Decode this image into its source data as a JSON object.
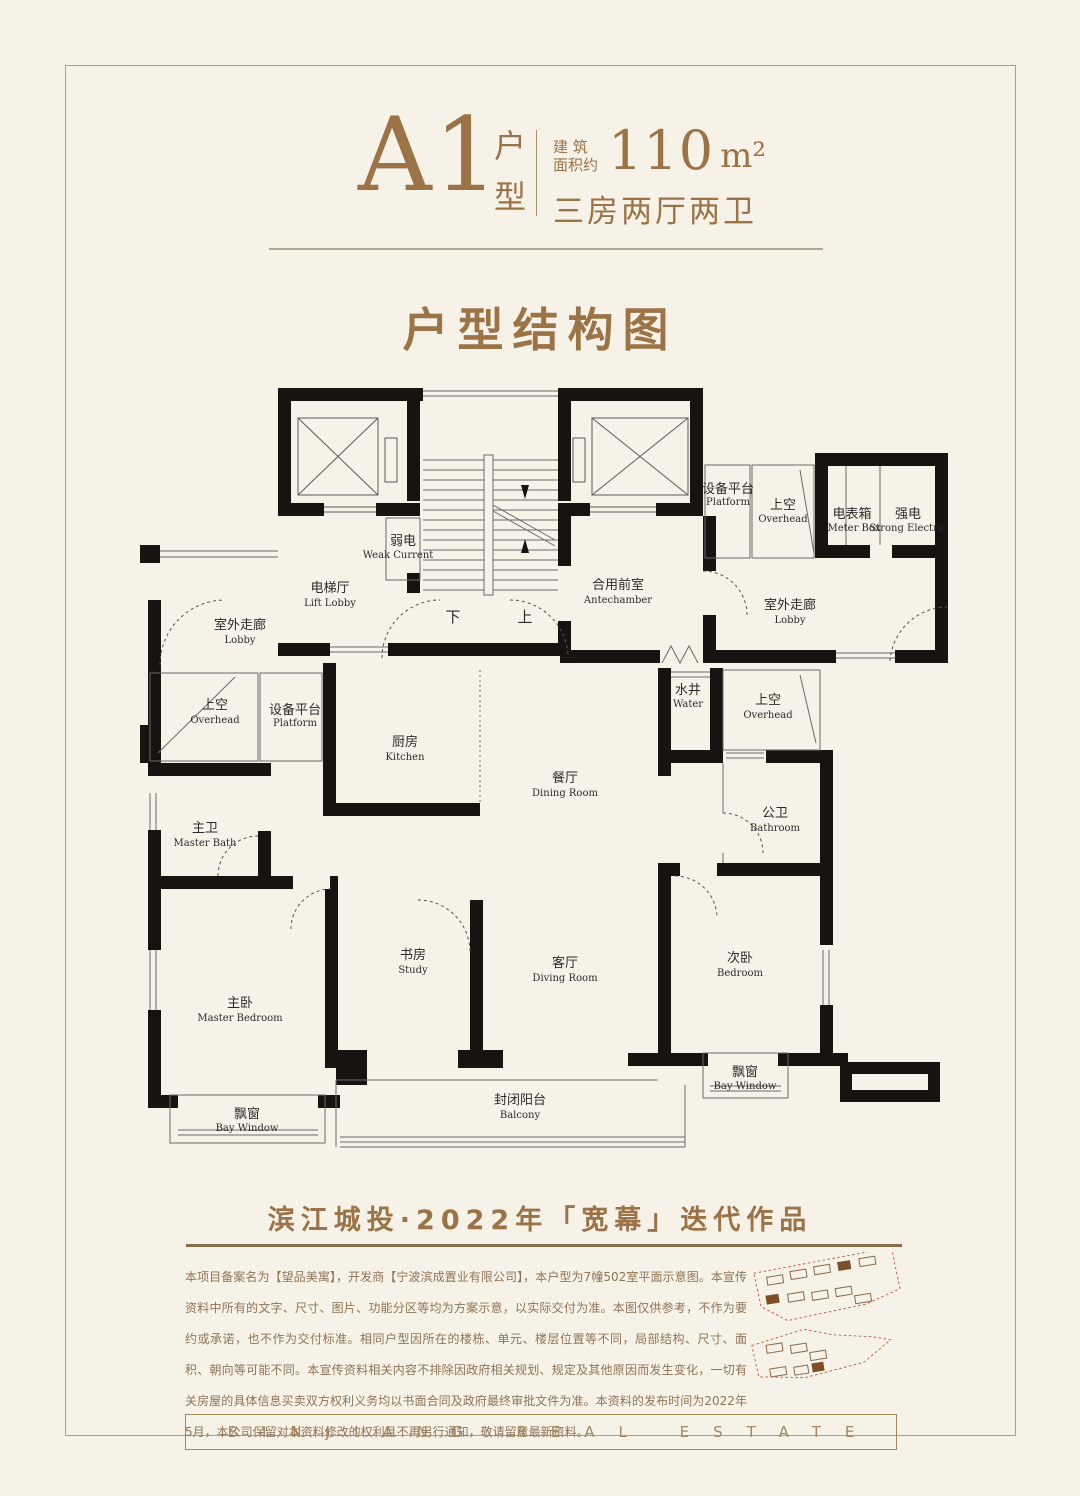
{
  "page": {
    "background": "#f6f2e8",
    "accent": "#9b7347"
  },
  "header": {
    "unit": "A1",
    "type_char1": "户",
    "type_char2": "型",
    "area_label_l1": "建 筑",
    "area_label_l2": "面积约",
    "area_value": "110",
    "area_unit": "m²",
    "layout": "三房两厅两卫"
  },
  "title": "户型结构图",
  "plan": {
    "rooms": [
      {
        "zh": "弱电",
        "en": "Weak Current"
      },
      {
        "zh": "电梯厅",
        "en": "Lift Lobby"
      },
      {
        "zh": "室外走廊",
        "en": "Lobby"
      },
      {
        "zh": "合用前室",
        "en": "Antechamber"
      },
      {
        "zh": "设备平台",
        "en": "Platform"
      },
      {
        "zh": "上空",
        "en": "Overhead"
      },
      {
        "zh": "电表箱",
        "en": "Meter Box"
      },
      {
        "zh": "强电",
        "en": "Strong Electric"
      },
      {
        "zh": "室外走廊",
        "en": "Lobby"
      },
      {
        "zh": "上空",
        "en": "Overhead"
      },
      {
        "zh": "设备平台",
        "en": "Platform"
      },
      {
        "zh": "厨房",
        "en": "Kitchen"
      },
      {
        "zh": "餐厅",
        "en": "Dining Room"
      },
      {
        "zh": "水井",
        "en": "Water"
      },
      {
        "zh": "上空",
        "en": "Overhead"
      },
      {
        "zh": "主卫",
        "en": "Master Bath"
      },
      {
        "zh": "公卫",
        "en": "Bathroom"
      },
      {
        "zh": "书房",
        "en": "Study"
      },
      {
        "zh": "客厅",
        "en": "Diving Room"
      },
      {
        "zh": "次卧",
        "en": "Bedroom"
      },
      {
        "zh": "主卧",
        "en": "Master Bedroom"
      },
      {
        "zh": "封闭阳台",
        "en": "Balcony"
      },
      {
        "zh": "飘窗",
        "en": "Bay Window"
      },
      {
        "zh": "飘窗",
        "en": "Bay Window"
      }
    ],
    "stairs": {
      "down": "下",
      "up": "上"
    }
  },
  "tagline": "滨江城投·2022年「宽幕」迭代作品",
  "disclaimer": "本项目备案名为【望品美寓】，开发商【宁波滨成置业有限公司】，本户型为7幢502室平面示意图。本宣传资料中所有的文字、尺寸、图片、功能分区等均为方案示意，以实际交付为准。本图仅供参考，不作为要约或承诺，也不作为交付标准。相同户型因所在的楼栋、单元、楼层位置等不同，局部结构、尺寸、面积、朝向等可能不同。本宣传资料相关内容不排除因政府相关规划、规定及其他原因而发生变化，一切有关房屋的具体信息买卖双方权利义务均以书面合同及政府最终审批文件为准。本资料的发布时间为2022年5月，本公司保留对本资料修改的权利且不再另行通知，敬请留意最新资料。",
  "footer": "BINJIANG REAL ESTATE"
}
